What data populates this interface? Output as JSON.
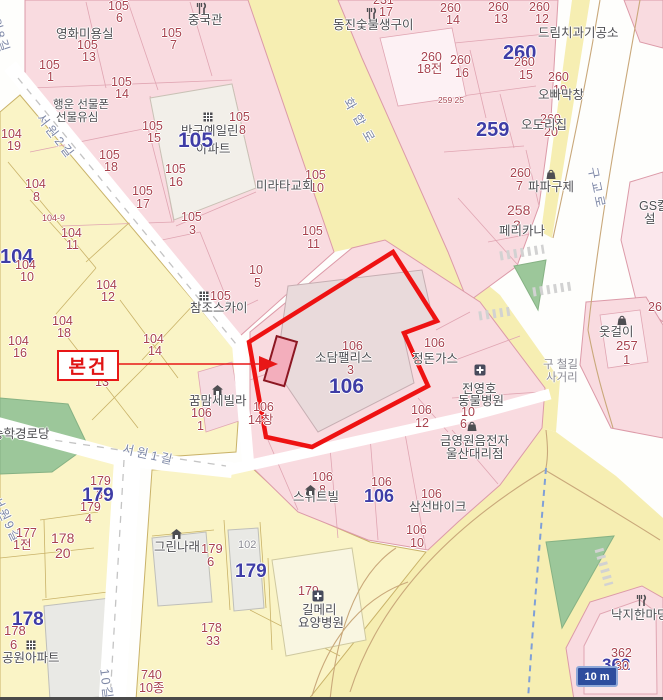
{
  "callout": {
    "label": "본건"
  },
  "scale": {
    "label": "10 m"
  },
  "colors": {
    "j": "#a8424e",
    "b": "#3f3da6",
    "p": "#4e4e52",
    "r": "#7e88a6",
    "g": "#8a8a92",
    "boundary": "#ee1212",
    "parcel_pink": "#f9dbe0",
    "parcel_yellow": "#faf4c6",
    "road_yellow": "#f6eeb2",
    "green": "#9cc79a"
  },
  "labels": [
    {
      "t": "105",
      "x": 108,
      "y": 0,
      "c": "j"
    },
    {
      "t": "6",
      "x": 116,
      "y": 12,
      "c": "j"
    },
    {
      "t": "중국관",
      "x": 188,
      "y": 14,
      "c": "p"
    },
    {
      "t": "영화미용실",
      "x": 56,
      "y": 28,
      "c": "p"
    },
    {
      "t": "105",
      "x": 161,
      "y": 27,
      "c": "j"
    },
    {
      "t": "7",
      "x": 170,
      "y": 39,
      "c": "j"
    },
    {
      "t": "105",
      "x": 77,
      "y": 39,
      "c": "j"
    },
    {
      "t": "13",
      "x": 82,
      "y": 51,
      "c": "j"
    },
    {
      "t": "105",
      "x": 39,
      "y": 59,
      "c": "j"
    },
    {
      "t": "1",
      "x": 47,
      "y": 71,
      "c": "j"
    },
    {
      "t": "105",
      "x": 111,
      "y": 76,
      "c": "j"
    },
    {
      "t": "14",
      "x": 115,
      "y": 88,
      "c": "j"
    },
    {
      "t": "행운 선물폰",
      "x": 53,
      "y": 100,
      "c": "p",
      "s": 11.5
    },
    {
      "t": "선물유심",
      "x": 56,
      "y": 113,
      "c": "p",
      "s": 11.5
    },
    {
      "t": "105",
      "x": 142,
      "y": 120,
      "c": "j"
    },
    {
      "t": "15",
      "x": 147,
      "y": 132,
      "c": "j"
    },
    {
      "t": "104",
      "x": 1,
      "y": 128,
      "c": "j"
    },
    {
      "t": "19",
      "x": 7,
      "y": 140,
      "c": "j"
    },
    {
      "t": "반구예일린",
      "x": 181,
      "y": 125,
      "c": "p"
    },
    {
      "t": "아파트",
      "x": 196,
      "y": 143,
      "c": "p"
    },
    {
      "t": "105",
      "x": 178,
      "y": 130,
      "c": "b",
      "s": 21,
      "w": 700
    },
    {
      "t": "105",
      "x": 229,
      "y": 111,
      "c": "j"
    },
    {
      "t": "8",
      "x": 239,
      "y": 124,
      "c": "j"
    },
    {
      "t": "105",
      "x": 99,
      "y": 149,
      "c": "j"
    },
    {
      "t": "18",
      "x": 104,
      "y": 161,
      "c": "j"
    },
    {
      "t": "104",
      "x": 25,
      "y": 178,
      "c": "j"
    },
    {
      "t": "8",
      "x": 33,
      "y": 191,
      "c": "j"
    },
    {
      "t": "105",
      "x": 165,
      "y": 163,
      "c": "j"
    },
    {
      "t": "16",
      "x": 169,
      "y": 176,
      "c": "j"
    },
    {
      "t": "105",
      "x": 132,
      "y": 185,
      "c": "j"
    },
    {
      "t": "17",
      "x": 136,
      "y": 198,
      "c": "j"
    },
    {
      "t": "105",
      "x": 181,
      "y": 211,
      "c": "j"
    },
    {
      "t": "3",
      "x": 189,
      "y": 224,
      "c": "j"
    },
    {
      "t": "105",
      "x": 305,
      "y": 169,
      "c": "j"
    },
    {
      "t": "10",
      "x": 310,
      "y": 182,
      "c": "j"
    },
    {
      "t": "미라타교회",
      "x": 256,
      "y": 180,
      "c": "p"
    },
    {
      "t": "105",
      "x": 302,
      "y": 225,
      "c": "j"
    },
    {
      "t": "11",
      "x": 307,
      "y": 238,
      "c": "j"
    },
    {
      "t": "10",
      "x": 249,
      "y": 264,
      "c": "j"
    },
    {
      "t": "5",
      "x": 254,
      "y": 277,
      "c": "j"
    },
    {
      "t": "105",
      "x": 210,
      "y": 290,
      "c": "j"
    },
    {
      "t": "참조스카이",
      "x": 190,
      "y": 302,
      "c": "p"
    },
    {
      "t": "104-9",
      "x": 42,
      "y": 214,
      "c": "j",
      "s": 9
    },
    {
      "t": "104",
      "x": 0,
      "y": 247,
      "c": "b",
      "w": 700
    },
    {
      "t": "104",
      "x": 61,
      "y": 227,
      "c": "j"
    },
    {
      "t": "11",
      "x": 66,
      "y": 239,
      "c": "j"
    },
    {
      "t": "104",
      "x": 15,
      "y": 259,
      "c": "j"
    },
    {
      "t": "10",
      "x": 20,
      "y": 271,
      "c": "j"
    },
    {
      "t": "104",
      "x": 96,
      "y": 279,
      "c": "j"
    },
    {
      "t": "12",
      "x": 101,
      "y": 291,
      "c": "j"
    },
    {
      "t": "104",
      "x": 52,
      "y": 315,
      "c": "j"
    },
    {
      "t": "18",
      "x": 57,
      "y": 327,
      "c": "j"
    },
    {
      "t": "104",
      "x": 8,
      "y": 335,
      "c": "j"
    },
    {
      "t": "16",
      "x": 13,
      "y": 347,
      "c": "j"
    },
    {
      "t": "104",
      "x": 143,
      "y": 333,
      "c": "j"
    },
    {
      "t": "14",
      "x": 148,
      "y": 345,
      "c": "j"
    },
    {
      "t": "13",
      "x": 95,
      "y": 376,
      "c": "j"
    },
    {
      "t": "서원8길",
      "x": -4,
      "y": 4,
      "c": "r",
      "r": 72,
      "sp": 2
    },
    {
      "t": "서원2길",
      "x": 44,
      "y": 112,
      "c": "r",
      "r": 52,
      "sp": 3
    },
    {
      "t": "화합로",
      "x": 352,
      "y": 96,
      "c": "r",
      "r": 60,
      "sp": 7
    },
    {
      "t": "231",
      "x": 373,
      "y": -6,
      "c": "j"
    },
    {
      "t": "17",
      "x": 379,
      "y": 6,
      "c": "j"
    },
    {
      "t": "동진숯불생구이",
      "x": 333,
      "y": 19,
      "c": "p",
      "s": 12.5
    },
    {
      "t": "260",
      "x": 440,
      "y": 2,
      "c": "j"
    },
    {
      "t": "14",
      "x": 446,
      "y": 14,
      "c": "j"
    },
    {
      "t": "260",
      "x": 488,
      "y": 1,
      "c": "j"
    },
    {
      "t": "13",
      "x": 494,
      "y": 13,
      "c": "j"
    },
    {
      "t": "260",
      "x": 529,
      "y": 1,
      "c": "j"
    },
    {
      "t": "12",
      "x": 535,
      "y": 13,
      "c": "j"
    },
    {
      "t": "드림치과기공소",
      "x": 538,
      "y": 27,
      "c": "p",
      "s": 12.5
    },
    {
      "t": "260",
      "x": 421,
      "y": 51,
      "c": "j"
    },
    {
      "t": "18전",
      "x": 417,
      "y": 63,
      "c": "j"
    },
    {
      "t": "260",
      "x": 450,
      "y": 54,
      "c": "j"
    },
    {
      "t": "16",
      "x": 455,
      "y": 67,
      "c": "j"
    },
    {
      "t": "260",
      "x": 503,
      "y": 43,
      "c": "b",
      "w": 700
    },
    {
      "t": "260",
      "x": 514,
      "y": 56,
      "c": "j"
    },
    {
      "t": "15",
      "x": 519,
      "y": 69,
      "c": "j"
    },
    {
      "t": "260",
      "x": 548,
      "y": 71,
      "c": "j"
    },
    {
      "t": "19",
      "x": 553,
      "y": 84,
      "c": "j"
    },
    {
      "t": "오빠막창",
      "x": 538,
      "y": 89,
      "c": "p"
    },
    {
      "t": "259 25",
      "x": 438,
      "y": 96,
      "c": "j",
      "s": 8.5
    },
    {
      "t": "259",
      "x": 476,
      "y": 120,
      "c": "b",
      "w": 700
    },
    {
      "t": "260",
      "x": 540,
      "y": 113,
      "c": "j"
    },
    {
      "t": "20",
      "x": 544,
      "y": 126,
      "c": "j"
    },
    {
      "t": "오도리집",
      "x": 521,
      "y": 119,
      "c": "p"
    },
    {
      "t": "260",
      "x": 510,
      "y": 167,
      "c": "j"
    },
    {
      "t": "7",
      "x": 516,
      "y": 180,
      "c": "j"
    },
    {
      "t": "파파구제",
      "x": 528,
      "y": 181,
      "c": "p"
    },
    {
      "t": "258",
      "x": 507,
      "y": 203,
      "c": "j",
      "s": 14
    },
    {
      "t": "3",
      "x": 513,
      "y": 218,
      "c": "j",
      "s": 14
    },
    {
      "t": "페리카나",
      "x": 499,
      "y": 225,
      "c": "p",
      "s": 12.5
    },
    {
      "t": "GS칼",
      "x": 639,
      "y": 200,
      "c": "p"
    },
    {
      "t": "설",
      "x": 644,
      "y": 213,
      "c": "p"
    },
    {
      "t": "구교로",
      "x": 598,
      "y": 166,
      "c": "r",
      "r": 78,
      "sp": 3
    },
    {
      "t": "옷걸이",
      "x": 599,
      "y": 326,
      "c": "p"
    },
    {
      "t": "257",
      "x": 616,
      "y": 339,
      "c": "j",
      "s": 13
    },
    {
      "t": "1",
      "x": 623,
      "y": 353,
      "c": "j",
      "s": 13
    },
    {
      "t": "26",
      "x": 648,
      "y": 301,
      "c": "j"
    },
    {
      "t": "구 철길",
      "x": 543,
      "y": 360,
      "c": "g",
      "s": 11.5
    },
    {
      "t": "사거리",
      "x": 546,
      "y": 373,
      "c": "g",
      "s": 11.5
    },
    {
      "t": "106",
      "x": 342,
      "y": 340,
      "c": "j"
    },
    {
      "t": "소담팰리스",
      "x": 315,
      "y": 352,
      "c": "p",
      "s": 12.5
    },
    {
      "t": "3",
      "x": 347,
      "y": 364,
      "c": "j"
    },
    {
      "t": "106",
      "x": 329,
      "y": 376,
      "c": "b",
      "s": 21,
      "w": 700
    },
    {
      "t": "꿈맘세빌라",
      "x": 189,
      "y": 395,
      "c": "p"
    },
    {
      "t": "106",
      "x": 191,
      "y": 407,
      "c": "j"
    },
    {
      "t": "1",
      "x": 197,
      "y": 420,
      "c": "j"
    },
    {
      "t": "106",
      "x": 253,
      "y": 401,
      "c": "j"
    },
    {
      "t": "14창",
      "x": 248,
      "y": 414,
      "c": "j"
    },
    {
      "t": "106",
      "x": 424,
      "y": 337,
      "c": "j"
    },
    {
      "t": "정돈가스",
      "x": 412,
      "y": 353,
      "c": "p"
    },
    {
      "t": "전영호",
      "x": 462,
      "y": 383,
      "c": "p"
    },
    {
      "t": "동물병원",
      "x": 458,
      "y": 395,
      "c": "p"
    },
    {
      "t": "10",
      "x": 461,
      "y": 406,
      "c": "j"
    },
    {
      "t": "6",
      "x": 460,
      "y": 418,
      "c": "j"
    },
    {
      "t": "금영원음전자",
      "x": 440,
      "y": 435,
      "c": "p"
    },
    {
      "t": "울산대리점",
      "x": 446,
      "y": 448,
      "c": "p"
    },
    {
      "t": "106",
      "x": 411,
      "y": 404,
      "c": "j"
    },
    {
      "t": "12",
      "x": 415,
      "y": 417,
      "c": "j"
    },
    {
      "t": "106",
      "x": 312,
      "y": 471,
      "c": "j"
    },
    {
      "t": "8",
      "x": 319,
      "y": 484,
      "c": "j"
    },
    {
      "t": "스위트빌",
      "x": 293,
      "y": 491,
      "c": "p"
    },
    {
      "t": "106",
      "x": 371,
      "y": 476,
      "c": "j"
    },
    {
      "t": "106",
      "x": 364,
      "y": 487,
      "c": "b",
      "s": 18,
      "w": 700
    },
    {
      "t": "106",
      "x": 421,
      "y": 488,
      "c": "j"
    },
    {
      "t": "삼선바이크",
      "x": 409,
      "y": 501,
      "c": "p"
    },
    {
      "t": "106",
      "x": 406,
      "y": 524,
      "c": "j"
    },
    {
      "t": "10",
      "x": 410,
      "y": 537,
      "c": "j"
    },
    {
      "t": "서원1길",
      "x": 124,
      "y": 443,
      "c": "r",
      "r": 13,
      "sp": 3
    },
    {
      "t": "서원9길",
      "x": 1,
      "y": 495,
      "c": "r",
      "r": 64,
      "sp": 2
    },
    {
      "t": "179",
      "x": 90,
      "y": 475,
      "c": "j"
    },
    {
      "t": "3",
      "x": 96,
      "y": 489,
      "c": "j"
    },
    {
      "t": "179",
      "x": 82,
      "y": 486,
      "c": "b",
      "s": 19,
      "w": 700
    },
    {
      "t": "179",
      "x": 80,
      "y": 501,
      "c": "j"
    },
    {
      "t": "4",
      "x": 85,
      "y": 513,
      "c": "j"
    },
    {
      "t": "177",
      "x": 16,
      "y": 527,
      "c": "j"
    },
    {
      "t": "1전",
      "x": 13,
      "y": 539,
      "c": "j"
    },
    {
      "t": "178",
      "x": 51,
      "y": 531,
      "c": "j",
      "s": 14
    },
    {
      "t": "20",
      "x": 55,
      "y": 546,
      "c": "j",
      "s": 14
    },
    {
      "t": "그린나래",
      "x": 154,
      "y": 541,
      "c": "p",
      "s": 12.5
    },
    {
      "t": "179",
      "x": 201,
      "y": 542,
      "c": "j",
      "s": 13
    },
    {
      "t": "6",
      "x": 207,
      "y": 555,
      "c": "j",
      "s": 13
    },
    {
      "t": "102",
      "x": 238,
      "y": 540,
      "c": "g",
      "s": 11
    },
    {
      "t": "179",
      "x": 235,
      "y": 562,
      "c": "b",
      "s": 19,
      "w": 700
    },
    {
      "t": "179",
      "x": 298,
      "y": 585,
      "c": "j"
    },
    {
      "t": "길메리",
      "x": 302,
      "y": 604,
      "c": "p",
      "s": 12.5
    },
    {
      "t": "요양병원",
      "x": 298,
      "y": 617,
      "c": "p",
      "s": 12.5
    },
    {
      "t": "178",
      "x": 12,
      "y": 610,
      "c": "b",
      "s": 19,
      "w": 700
    },
    {
      "t": "178",
      "x": 4,
      "y": 624,
      "c": "j",
      "s": 13
    },
    {
      "t": "6",
      "x": 10,
      "y": 638,
      "c": "j",
      "s": 13
    },
    {
      "t": "공원아파트",
      "x": 2,
      "y": 652,
      "c": "p",
      "s": 12.5
    },
    {
      "t": "178",
      "x": 201,
      "y": 622,
      "c": "j"
    },
    {
      "t": "33",
      "x": 206,
      "y": 635,
      "c": "j"
    },
    {
      "t": "740",
      "x": 141,
      "y": 669,
      "c": "j"
    },
    {
      "t": "10종",
      "x": 139,
      "y": 682,
      "c": "j"
    },
    {
      "t": "10길",
      "x": 110,
      "y": 668,
      "c": "r",
      "r": 83,
      "sp": 2
    },
    {
      "t": "송학경로당",
      "x": -8,
      "y": 428,
      "c": "p"
    },
    {
      "t": "낙지한마당",
      "x": 611,
      "y": 609,
      "c": "p"
    },
    {
      "t": "362",
      "x": 611,
      "y": 647,
      "c": "j",
      "s": 12.5
    },
    {
      "t": "362",
      "x": 602,
      "y": 656,
      "c": "b",
      "s": 17,
      "w": 700
    },
    {
      "t": "30",
      "x": 615,
      "y": 660,
      "c": "j",
      "s": 12.5
    }
  ],
  "icons": [
    {
      "type": "restaurant",
      "x": 194,
      "y": 2
    },
    {
      "type": "restaurant",
      "x": 364,
      "y": 7
    },
    {
      "type": "restaurant",
      "x": 634,
      "y": 594
    },
    {
      "type": "apartment",
      "x": 202,
      "y": 110
    },
    {
      "type": "apartment",
      "x": 198,
      "y": 289
    },
    {
      "type": "apartment",
      "x": 25,
      "y": 638
    },
    {
      "type": "house",
      "x": 211,
      "y": 383
    },
    {
      "type": "house",
      "x": 170,
      "y": 527
    },
    {
      "type": "house",
      "x": 304,
      "y": 483
    },
    {
      "type": "bag",
      "x": 545,
      "y": 167
    },
    {
      "type": "bag",
      "x": 616,
      "y": 313
    },
    {
      "type": "bag",
      "x": 466,
      "y": 419
    },
    {
      "type": "hospital",
      "x": 474,
      "y": 363
    },
    {
      "type": "hospital",
      "x": 312,
      "y": 589
    }
  ]
}
